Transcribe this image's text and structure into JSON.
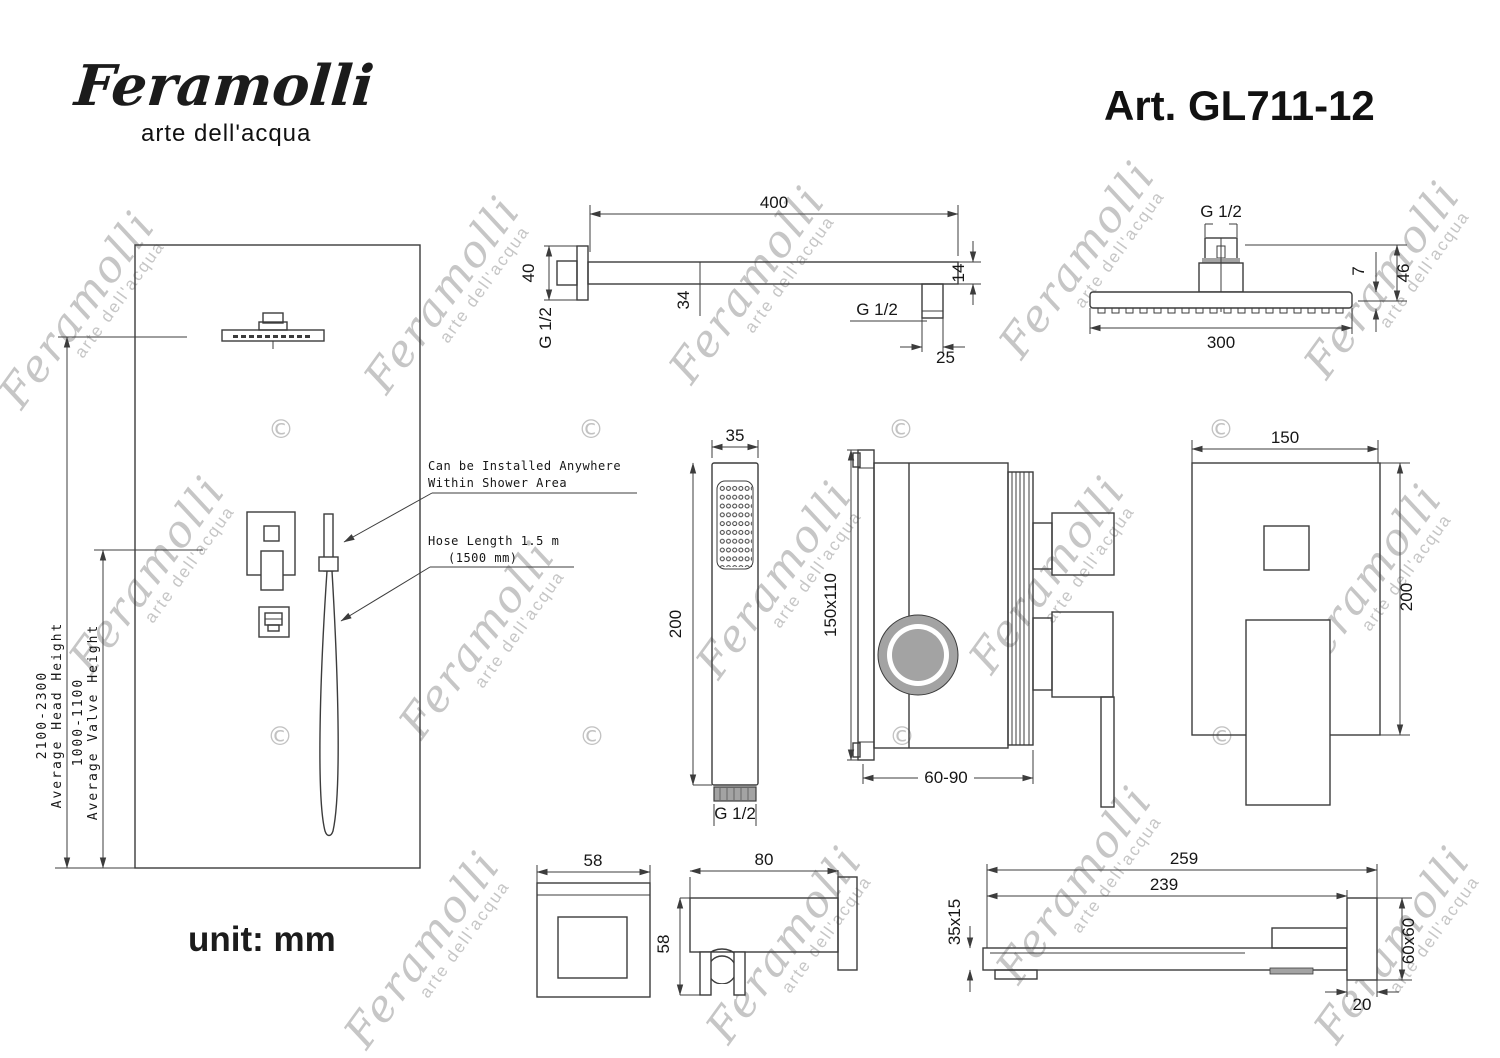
{
  "header": {
    "logo_name": "Feramolli",
    "logo_tagline": "arte dell'acqua",
    "art_number": "Art. GL711-12"
  },
  "footer": {
    "unit_label": "unit: mm"
  },
  "watermark": {
    "name": "Feramolli",
    "tagline": "arte dell'acqua",
    "copyright_symbol": "©"
  },
  "colors": {
    "line": "#3c3c3c",
    "shade_gray": "#a3a3a3",
    "watermark_gray": "#c6c6c6",
    "text_black": "#161616"
  },
  "installation_view": {
    "head_height_range": "2100-2300",
    "head_height_label": "Average Head Height",
    "valve_height_range": "1000-1100",
    "valve_height_label": "Average Valve Height",
    "handshower_note_line1": "Can be Installed Anywhere",
    "handshower_note_line2": "Within Shower Area",
    "hose_note_line1": "Hose Length 1.5 m",
    "hose_note_line2": "(1500 mm)"
  },
  "shower_arm_view": {
    "arm_length": "400",
    "flange_size": "40",
    "wall_thread": "G 1/2",
    "arm_offset": "34",
    "end_height": "14",
    "end_thread": "G 1/2",
    "end_width": "25"
  },
  "shower_head_view": {
    "thread": "G 1/2",
    "width": "300",
    "height": "46",
    "plate_thickness": "7"
  },
  "hand_shower_view": {
    "width": "35",
    "length": "200",
    "thread": "G 1/2"
  },
  "mixer_valve_view": {
    "rough_in_size": "150x110",
    "depth_range": "60-90"
  },
  "trim_plate_view": {
    "width": "150",
    "height": "200"
  },
  "holder_front_view": {
    "width": "58"
  },
  "holder_side_view": {
    "depth": "80",
    "height": "58"
  },
  "spout_view": {
    "total_length": "259",
    "body_length": "239",
    "profile_size": "35x15",
    "flange_size": "60x60",
    "flange_depth": "20"
  }
}
